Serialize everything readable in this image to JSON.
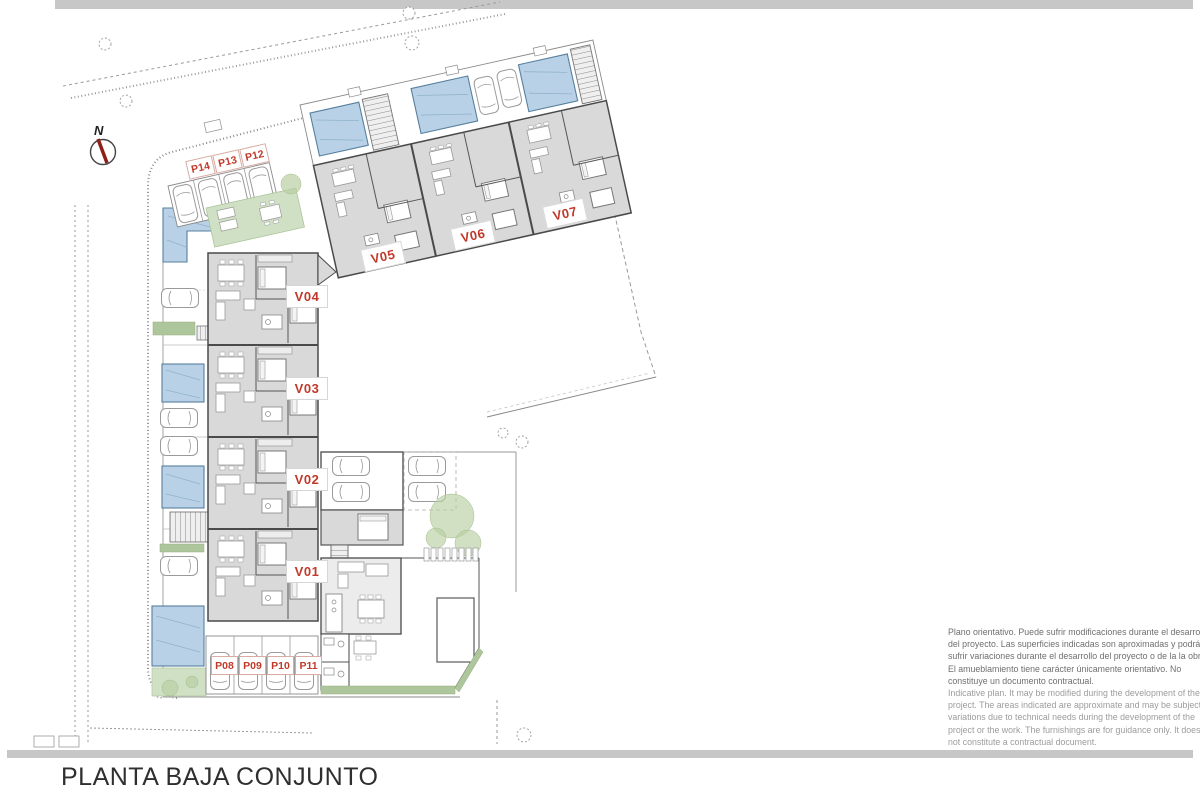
{
  "sheet": {
    "title": "PLANTA BAJA CONJUNTO",
    "north_label": "N"
  },
  "plan": {
    "villa_labels": [
      {
        "id": "V01"
      },
      {
        "id": "V02"
      },
      {
        "id": "V03"
      },
      {
        "id": "V04"
      },
      {
        "id": "V05"
      },
      {
        "id": "V06"
      },
      {
        "id": "V07"
      }
    ],
    "parking_labels": [
      {
        "id": "P08"
      },
      {
        "id": "P09"
      },
      {
        "id": "P10"
      },
      {
        "id": "P11"
      },
      {
        "id": "P12"
      },
      {
        "id": "P13"
      },
      {
        "id": "P14"
      }
    ]
  },
  "disclaimer": {
    "es": [
      "Plano orientativo. Puede sufrir modificaciones durante el desarrollo",
      "del proyecto. Las superficies indicadas son aproximadas y podrán",
      "sufrir variaciones durante el desarrollo del proyecto o de la la obra.",
      "El amueblamiento tiene carácter únicamente orientativo. No",
      "constituye un documento contractual."
    ],
    "en": [
      "Indicative plan. It may be modified during the development of the",
      "project. The areas indicated are approximate and may be subject to",
      "variations due to technical needs during the development of the",
      "project or the work. The furnishings are for guidance only. It does",
      "not constitute a contractual document."
    ]
  },
  "colors": {
    "label_red": "#c0392b",
    "pool_blue": "#b9d1e6",
    "building_gray": "#d9d9d9",
    "terrace_green": "#cfe0c5",
    "hedge_green": "#aec69b",
    "sheet_bar_gray": "#c7c7c7"
  }
}
